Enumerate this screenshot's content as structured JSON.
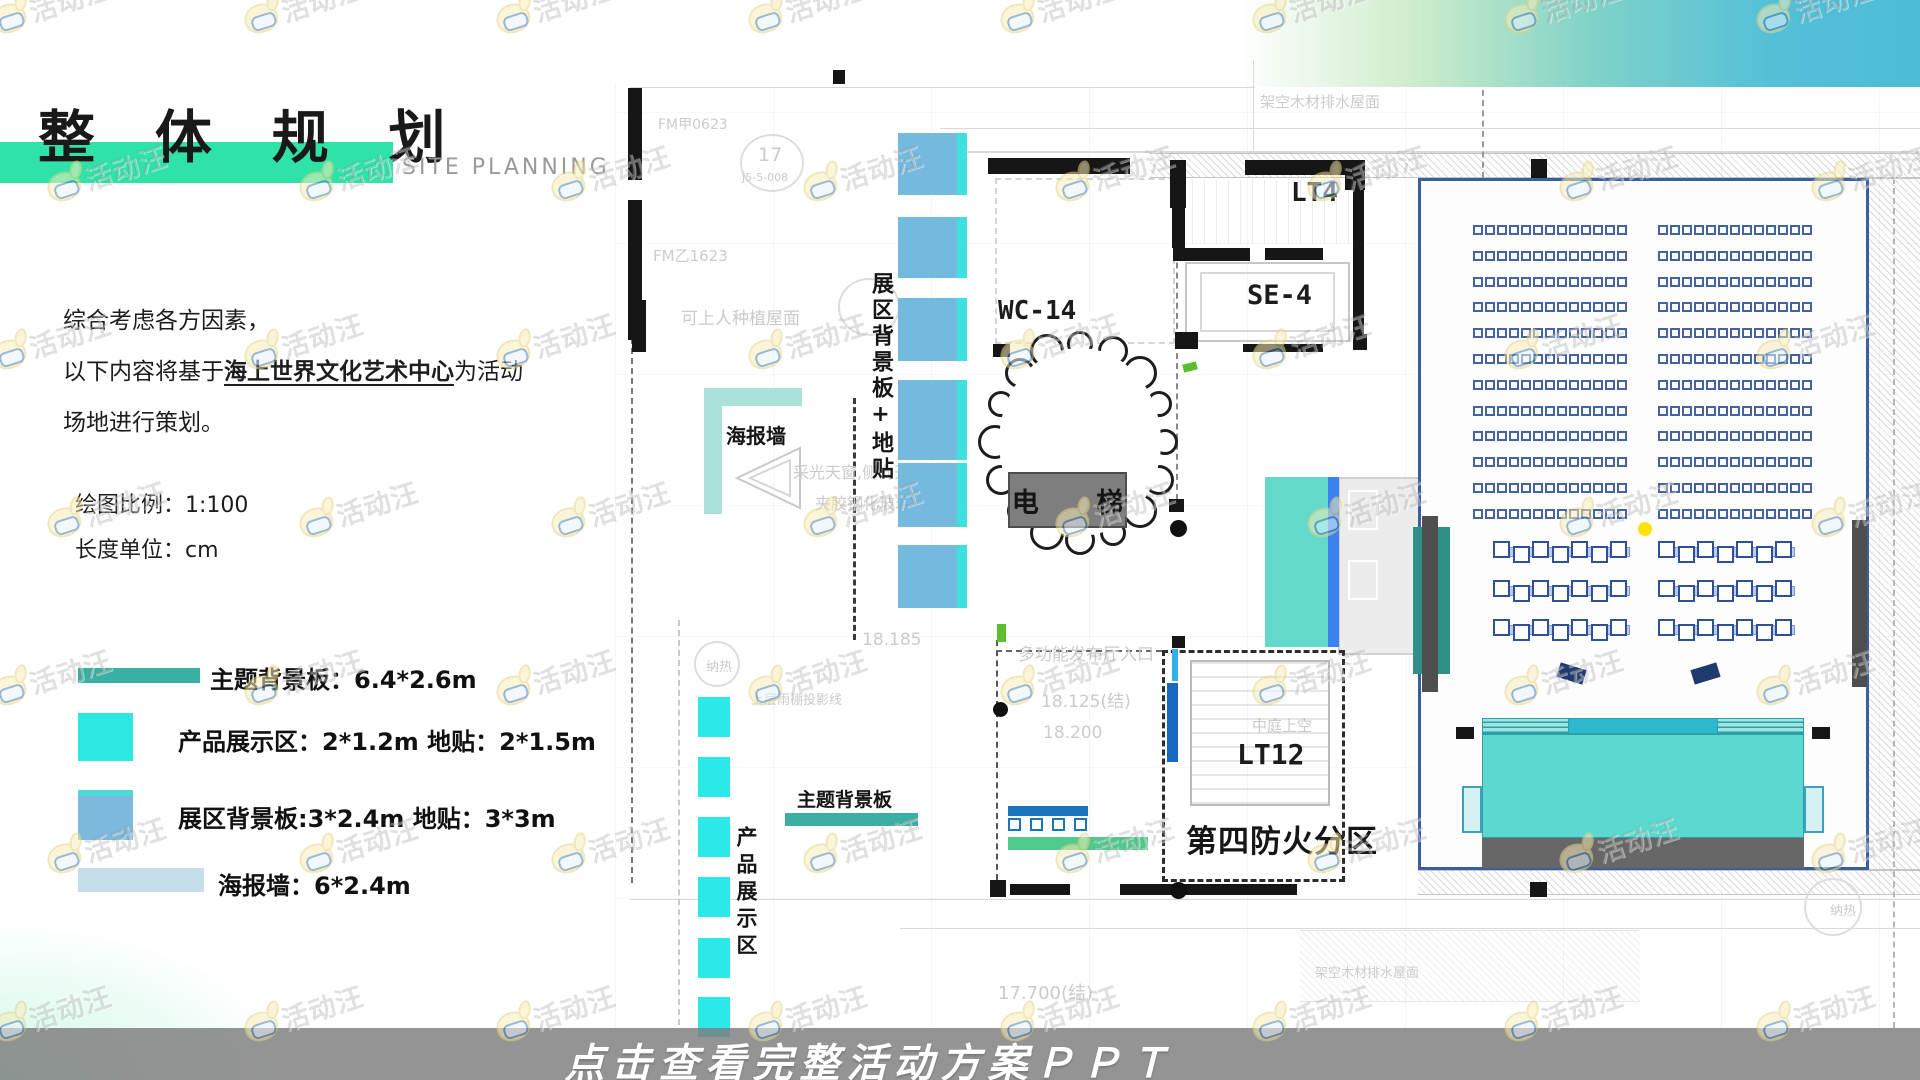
{
  "slide": {
    "title": "整 体 规 划",
    "subtitle": "SITE PLANNING",
    "intro_line1": "综合考虑各方因素，",
    "intro_line2_prefix": "以下内容将基于",
    "intro_line2_em": "海上世界文化艺术中心",
    "intro_line2_suffix": "为活动",
    "intro_line3": "场地进行策划。",
    "scale_label": "绘图比例：1:100",
    "unit_label": "长度单位：cm"
  },
  "legend": {
    "items": [
      {
        "label": "主题背景板：6.4*2.6m",
        "color": "#3AB0A4"
      },
      {
        "label": "产品展示区：2*1.2m 地贴：2*1.5m",
        "color": "#2BE8E3"
      },
      {
        "label": "展区背景板:3*2.4m 地贴：3*3m",
        "color": "#7CB9DD",
        "accent": "#4FD8DC"
      },
      {
        "label": "海报墙：6*2.4m",
        "color": "#C3DDEA"
      }
    ]
  },
  "plan": {
    "rooms": {
      "wc14": "WC-14",
      "lt4": "LT4",
      "se4": "SE-4",
      "lt12": "LT12",
      "elevator": "电 梯",
      "fire_zone": "第四防火分区"
    },
    "labels": {
      "poster_wall": "海报墙",
      "theme_backdrop": "主题背景板",
      "product_display": "产品展示区",
      "exhibit_backdrop": "展区背景板+地贴",
      "atrium": "中庭上空"
    },
    "cad_texts": [
      {
        "text": "FM甲0623",
        "x": 658,
        "y": 114,
        "size": 14
      },
      {
        "text": "17",
        "x": 758,
        "y": 144,
        "size": 19
      },
      {
        "text": "J5-5-008",
        "x": 742,
        "y": 171,
        "size": 11
      },
      {
        "text": "FM乙1623",
        "x": 653,
        "y": 245,
        "size": 15
      },
      {
        "text": "可上人种植屋面",
        "x": 681,
        "y": 304,
        "size": 17
      },
      {
        "text": "采光天窗,侧向开",
        "x": 793,
        "y": 459,
        "size": 16
      },
      {
        "text": "夹胶钢化玻璃",
        "x": 815,
        "y": 490,
        "size": 16
      },
      {
        "text": "18.185",
        "x": 862,
        "y": 630,
        "size": 17
      },
      {
        "text": "多功能发布厅入口",
        "x": 1018,
        "y": 640,
        "size": 17
      },
      {
        "text": "18.125(结)",
        "x": 1041,
        "y": 687,
        "size": 17
      },
      {
        "text": "18.200",
        "x": 1043,
        "y": 723,
        "size": 17
      },
      {
        "text": "中庭上空",
        "x": 1252,
        "y": 715,
        "size": 15
      },
      {
        "text": "17.700(结)",
        "x": 998,
        "y": 979,
        "size": 18
      },
      {
        "text": "架空木材排水屋面",
        "x": 1260,
        "y": 91,
        "size": 15
      },
      {
        "text": "架空木材排水屋面",
        "x": 1315,
        "y": 962,
        "size": 13
      },
      {
        "text": "上层雨棚投影线",
        "x": 751,
        "y": 689,
        "size": 13
      },
      {
        "text": "纳热",
        "x": 706,
        "y": 656,
        "size": 13
      },
      {
        "text": "纳热",
        "x": 1830,
        "y": 900,
        "size": 13
      }
    ]
  },
  "hall": {
    "seat_blocks": 2,
    "seat_rows": 12,
    "seats_per_row": 13,
    "bench_rows": 3,
    "bench_groups_per_row": 2,
    "seats_per_bench": 7
  },
  "banner": {
    "text": "点击查看完整活动方案ＰＰＴ"
  },
  "watermark": {
    "text": "活动汪"
  }
}
